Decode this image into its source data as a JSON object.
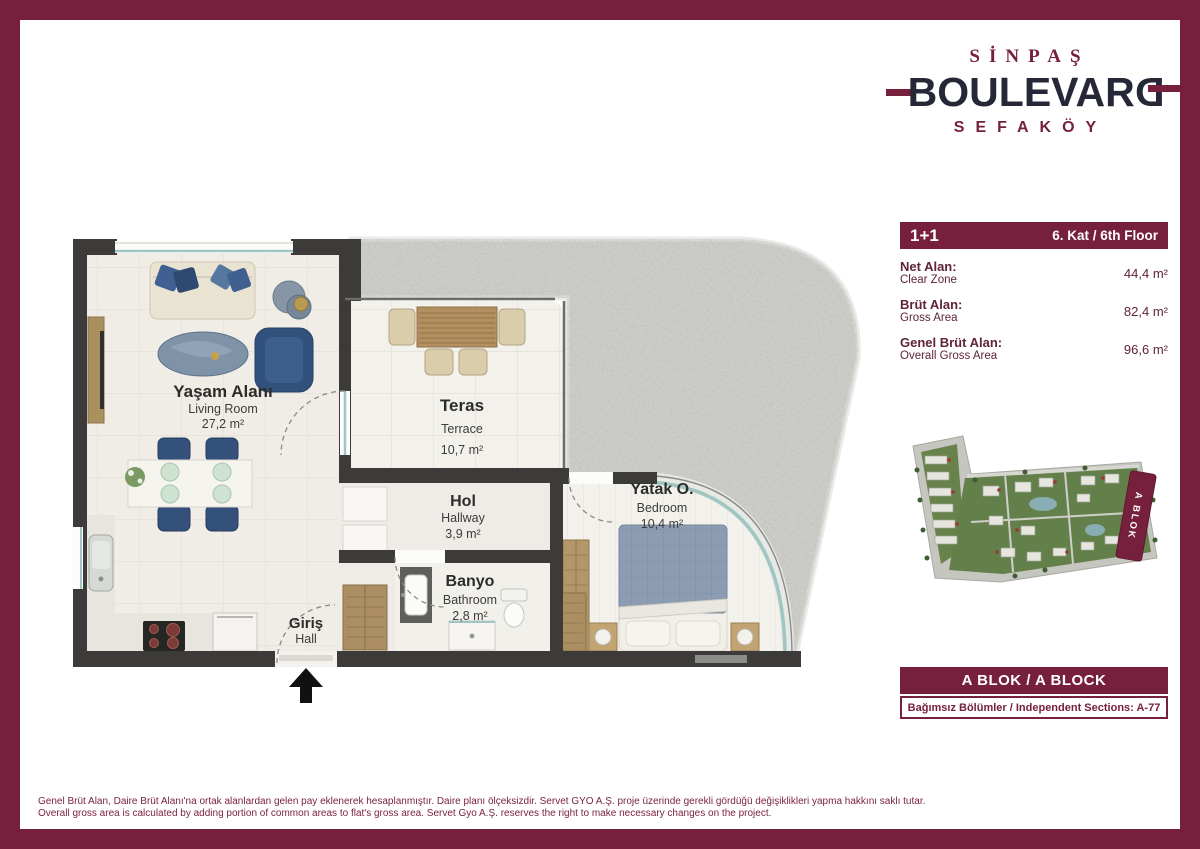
{
  "logo": {
    "brand_top": "SİNPAŞ",
    "brand_main_body": "BOULEVAR",
    "brand_main_last": "D",
    "brand_sub": "SEFAKÖY"
  },
  "info_panel": {
    "unit_type": "1+1",
    "floor": "6. Kat / 6th Floor",
    "rows": [
      {
        "label_tr": "Net Alan:",
        "label_en": "Clear Zone",
        "value": "44,4 m²"
      },
      {
        "label_tr": "Brüt Alan:",
        "label_en": "Gross Area",
        "value": "82,4 m²"
      },
      {
        "label_tr": "Genel Brüt Alan:",
        "label_en": "Overall Gross Area",
        "value": "96,6 m²"
      }
    ]
  },
  "site_plan": {
    "highlight_block": "A BLOK"
  },
  "block_bar": {
    "title": "A BLOK / A BLOCK"
  },
  "sections": {
    "text": "Bağımsız Bölümler / Independent Sections: A-77"
  },
  "rooms": {
    "living": {
      "name_tr": "Yaşam Alanı",
      "name_en": "Living Room",
      "area": "27,2 m²"
    },
    "terrace": {
      "name_tr": "Teras",
      "name_en": "Terrace",
      "area": "10,7 m²"
    },
    "hallway": {
      "name_tr": "Hol",
      "name_en": "Hallway",
      "area": "3,9 m²"
    },
    "bathroom": {
      "name_tr": "Banyo",
      "name_en": "Bathroom",
      "area": "2,8 m²"
    },
    "bedroom": {
      "name_tr": "Yatak O.",
      "name_en": "Bedroom",
      "area": "10,4 m²"
    },
    "entrance": {
      "name_tr": "Giriş",
      "name_en": "Hall"
    }
  },
  "disclaimer": {
    "line_tr": "Genel Brüt Alan, Daire Brüt Alanı'na ortak alanlardan gelen pay eklenerek hesaplanmıştır. Daire planı ölçeksizdir. Servet GYO A.Ş. proje üzerinde gerekli gördüğü değişiklikleri yapma hakkını saklı tutar.",
    "line_en": "Overall gross area is calculated by adding portion of common areas to flat's gross area. Servet Gyo A.Ş. reserves the right to make necessary changes on the project."
  },
  "colors": {
    "maroon": "#77203E",
    "logo_navy": "#262838",
    "wall": "#3c3b39",
    "furniture_blue": "#33517a",
    "glass_teal": "#9fc6c2"
  }
}
